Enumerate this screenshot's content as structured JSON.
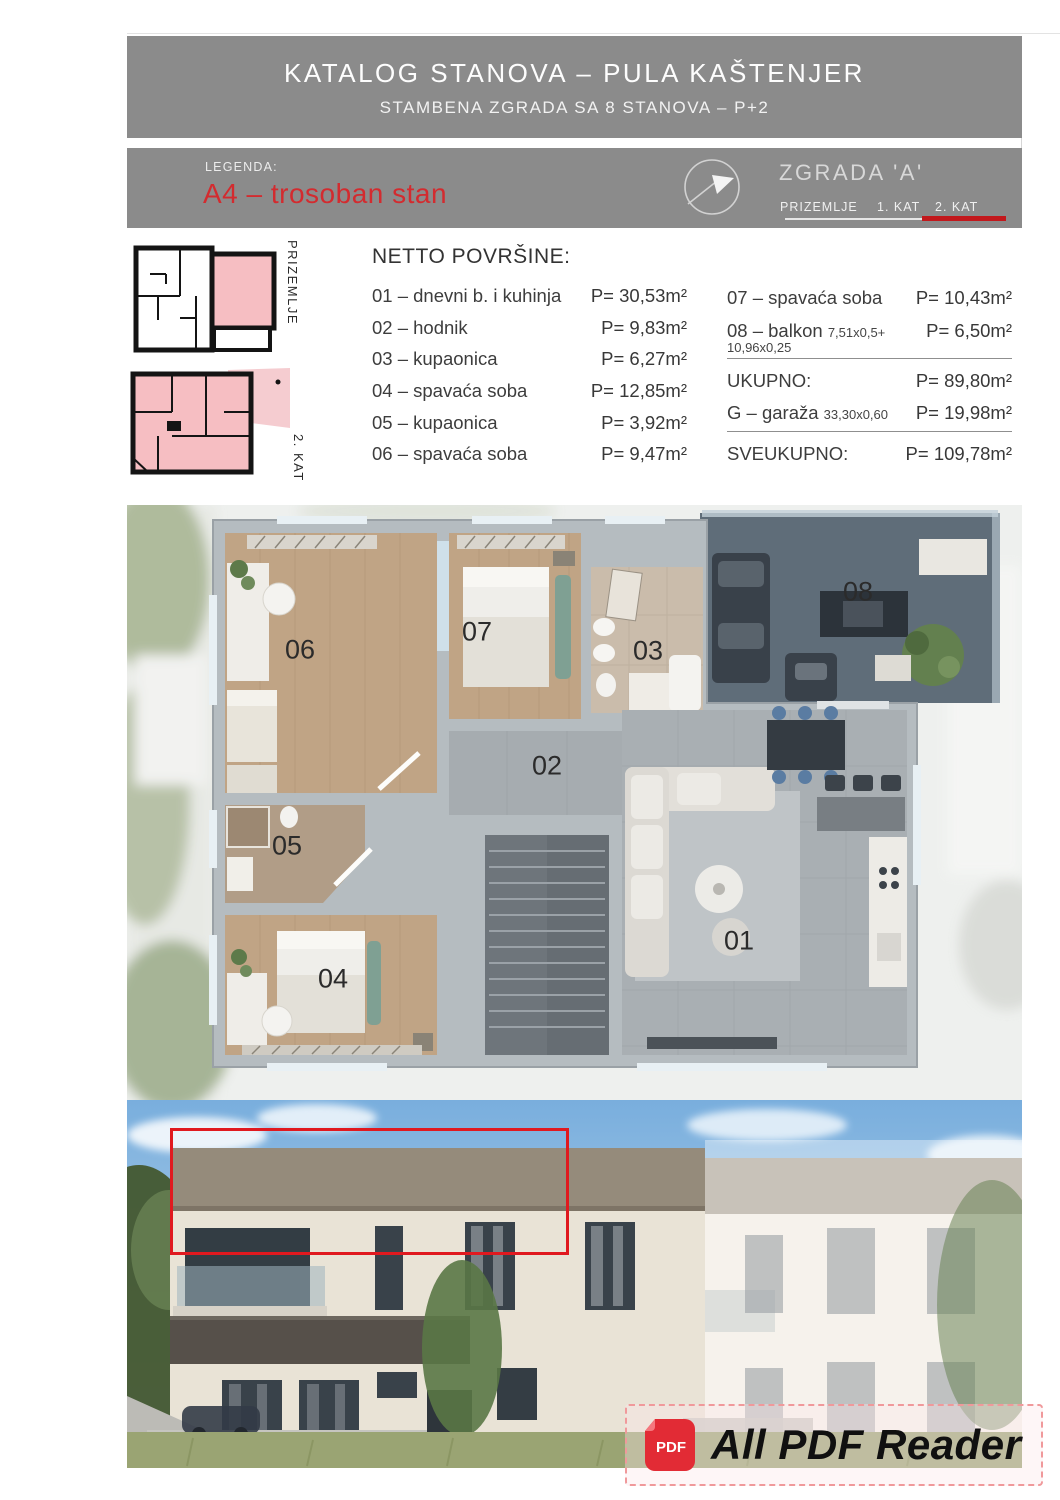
{
  "page": {
    "header": {
      "title": "KATALOG STANOVA – PULA KAŠTENJER",
      "subtitle": "STAMBENA ZGRADA SA 8 STANOVA – P+2"
    },
    "legend": {
      "label": "LEGENDA:",
      "unit": "A4 – trosoban stan",
      "building": "ZGRADA 'A'",
      "tabs": {
        "prizemlje": "PRIZEMLJE",
        "kat1": "1. KAT",
        "kat2": "2. KAT"
      }
    },
    "mini_plans": {
      "prizemlje": "PRIZEMLJE",
      "kat2": "2. KAT"
    },
    "areas": {
      "title": "NETTO POVRŠINE:",
      "rows_left": [
        {
          "label": "01 – dnevni b. i kuhinja",
          "value": "P= 30,53m²"
        },
        {
          "label": "02 – hodnik",
          "value": "P= 9,83m²"
        },
        {
          "label": "03 – kupaonica",
          "value": "P= 6,27m²"
        },
        {
          "label": "04 – spavaća soba",
          "value": "P= 12,85m²"
        },
        {
          "label": "05 – kupaonica",
          "value": "P= 3,92m²"
        },
        {
          "label": "06 – spavaća soba",
          "value": "P= 9,47m²"
        }
      ],
      "rows_right": {
        "r07": {
          "label": "07 – spavaća soba",
          "value": "P= 10,43m²"
        },
        "r08": {
          "label": "08 – balkon",
          "note": "7,51x0,5+",
          "note2": "10,96x0,25",
          "value": "P= 6,50m²"
        },
        "ukupno": {
          "label": "UKUPNO:",
          "value": "P= 89,80m²"
        },
        "garage": {
          "label": "G – garaža",
          "note": "33,30x0,60",
          "value": "P= 19,98m²"
        },
        "sveukupno": {
          "label": "SVEUKUPNO:",
          "value": "P= 109,78m²"
        }
      }
    },
    "floor_plan": {
      "rooms": {
        "r01": "01",
        "r02": "02",
        "r03": "03",
        "r04": "04",
        "r05": "05",
        "r06": "06",
        "r07": "07",
        "r08": "08"
      }
    },
    "watermark": {
      "app": "All PDF Reader",
      "icon": "PDF"
    },
    "colors": {
      "accent_red": "#d32b2f",
      "underline_red": "#c2181c",
      "band_gray": "#8b8b8b",
      "plan_pink": "#f6bec2",
      "highlight_box_red": "#e0191f"
    }
  }
}
